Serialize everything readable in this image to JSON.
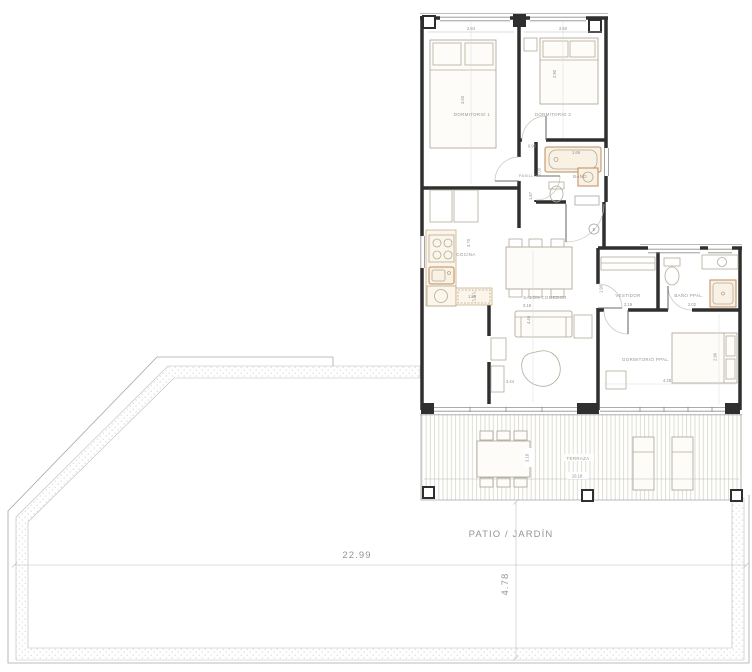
{
  "colors": {
    "wall": "#2f2f2f",
    "thin_line": "#a6a6a6",
    "furniture": "#b3ab9a",
    "fixture_stroke": "#c08a5a",
    "fixture_fill": "#f9f1e3",
    "deck_line": "#d9d9cb",
    "stipple": "#cfcfcf",
    "text": "#8f8f8f",
    "background": "#ffffff"
  },
  "rooms": {
    "dorm1": {
      "label": "DORMITORIO 1",
      "dim_w": "2.84",
      "dim_h": "3.60"
    },
    "dorm2": {
      "label": "DORMITORIO 2",
      "dim_w": "2.60",
      "dim_h": "2.90"
    },
    "bano": {
      "label": "BAÑO",
      "dim_tub": "1.66",
      "dim_a": "0.90",
      "dim_b": "2.00",
      "dim_c": "1.87"
    },
    "pasillo": {
      "label": "PASILLO"
    },
    "cocina": {
      "label": "COCINA",
      "dim_h": "3.70",
      "dim_w": "1.80"
    },
    "salon": {
      "label": "SALÓN COMEDOR",
      "dim_w": "3.19",
      "dim_h": "4.46",
      "dim_sofa": "3.44"
    },
    "vestidor": {
      "label": "VESTIDOR",
      "dim_w": "2.19",
      "dim_h": "1.90"
    },
    "bano_ppal": {
      "label": "BAÑO PPAL.",
      "dim_w": "2.02"
    },
    "dorm_ppal": {
      "label": "DORMITORIO PPAL.",
      "dim_w": "4.28",
      "dim_h": "2.96"
    },
    "terraza": {
      "label": "TERRAZA",
      "dim_w": "10.18",
      "dim_table": "3.18"
    },
    "patio": {
      "label": "PATIO / JARDÍN",
      "dim_w": "22.99",
      "dim_h": "4.78"
    }
  },
  "entrance": {
    "marker": "E"
  }
}
